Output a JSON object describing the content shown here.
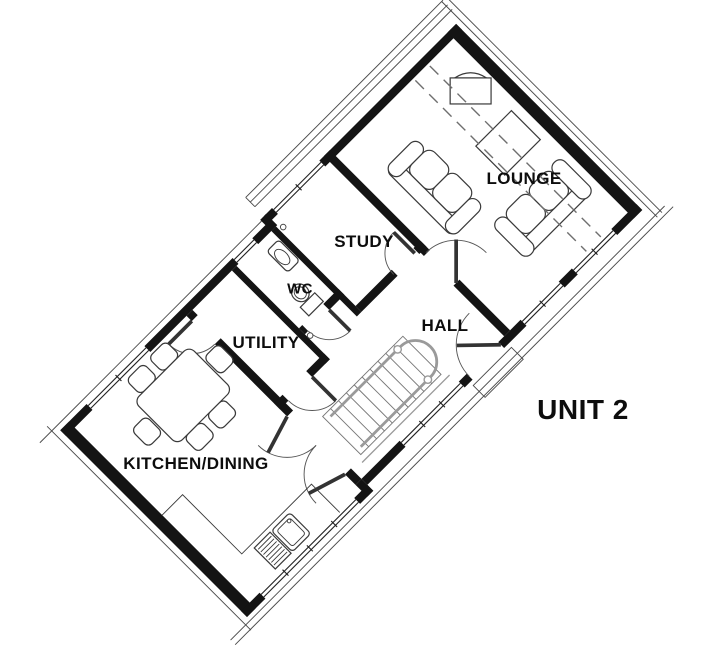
{
  "unit_label": "UNIT 2",
  "rooms": {
    "lounge": "LOUNGE",
    "study": "STUDY",
    "wc": "WC",
    "hall": "HALL",
    "utility": "UTILITY",
    "kitchen_dining": "KITCHEN/DINING"
  },
  "fixtures": {
    "lounge": [
      "tv-cabinet",
      "coffee-table",
      "two-seat-sofa",
      "two-seat-sofa"
    ],
    "kitchen_dining": [
      "dining-table",
      "six-dining-chairs",
      "sink-with-drainer",
      "worktop-counter"
    ],
    "wc": [
      "toilet",
      "wash-basin"
    ],
    "hall": [
      "staircase-with-handrail",
      "front-door"
    ],
    "study": [],
    "utility": []
  },
  "colors": {
    "wall": "#141414",
    "line": "#4a4a4a",
    "frame": "#222222",
    "furniture": "#3a3a3a",
    "rail": "#9a9a9a",
    "dash": "#6f6f6f",
    "label": "#0d0d0d",
    "bg": "#ffffff"
  }
}
